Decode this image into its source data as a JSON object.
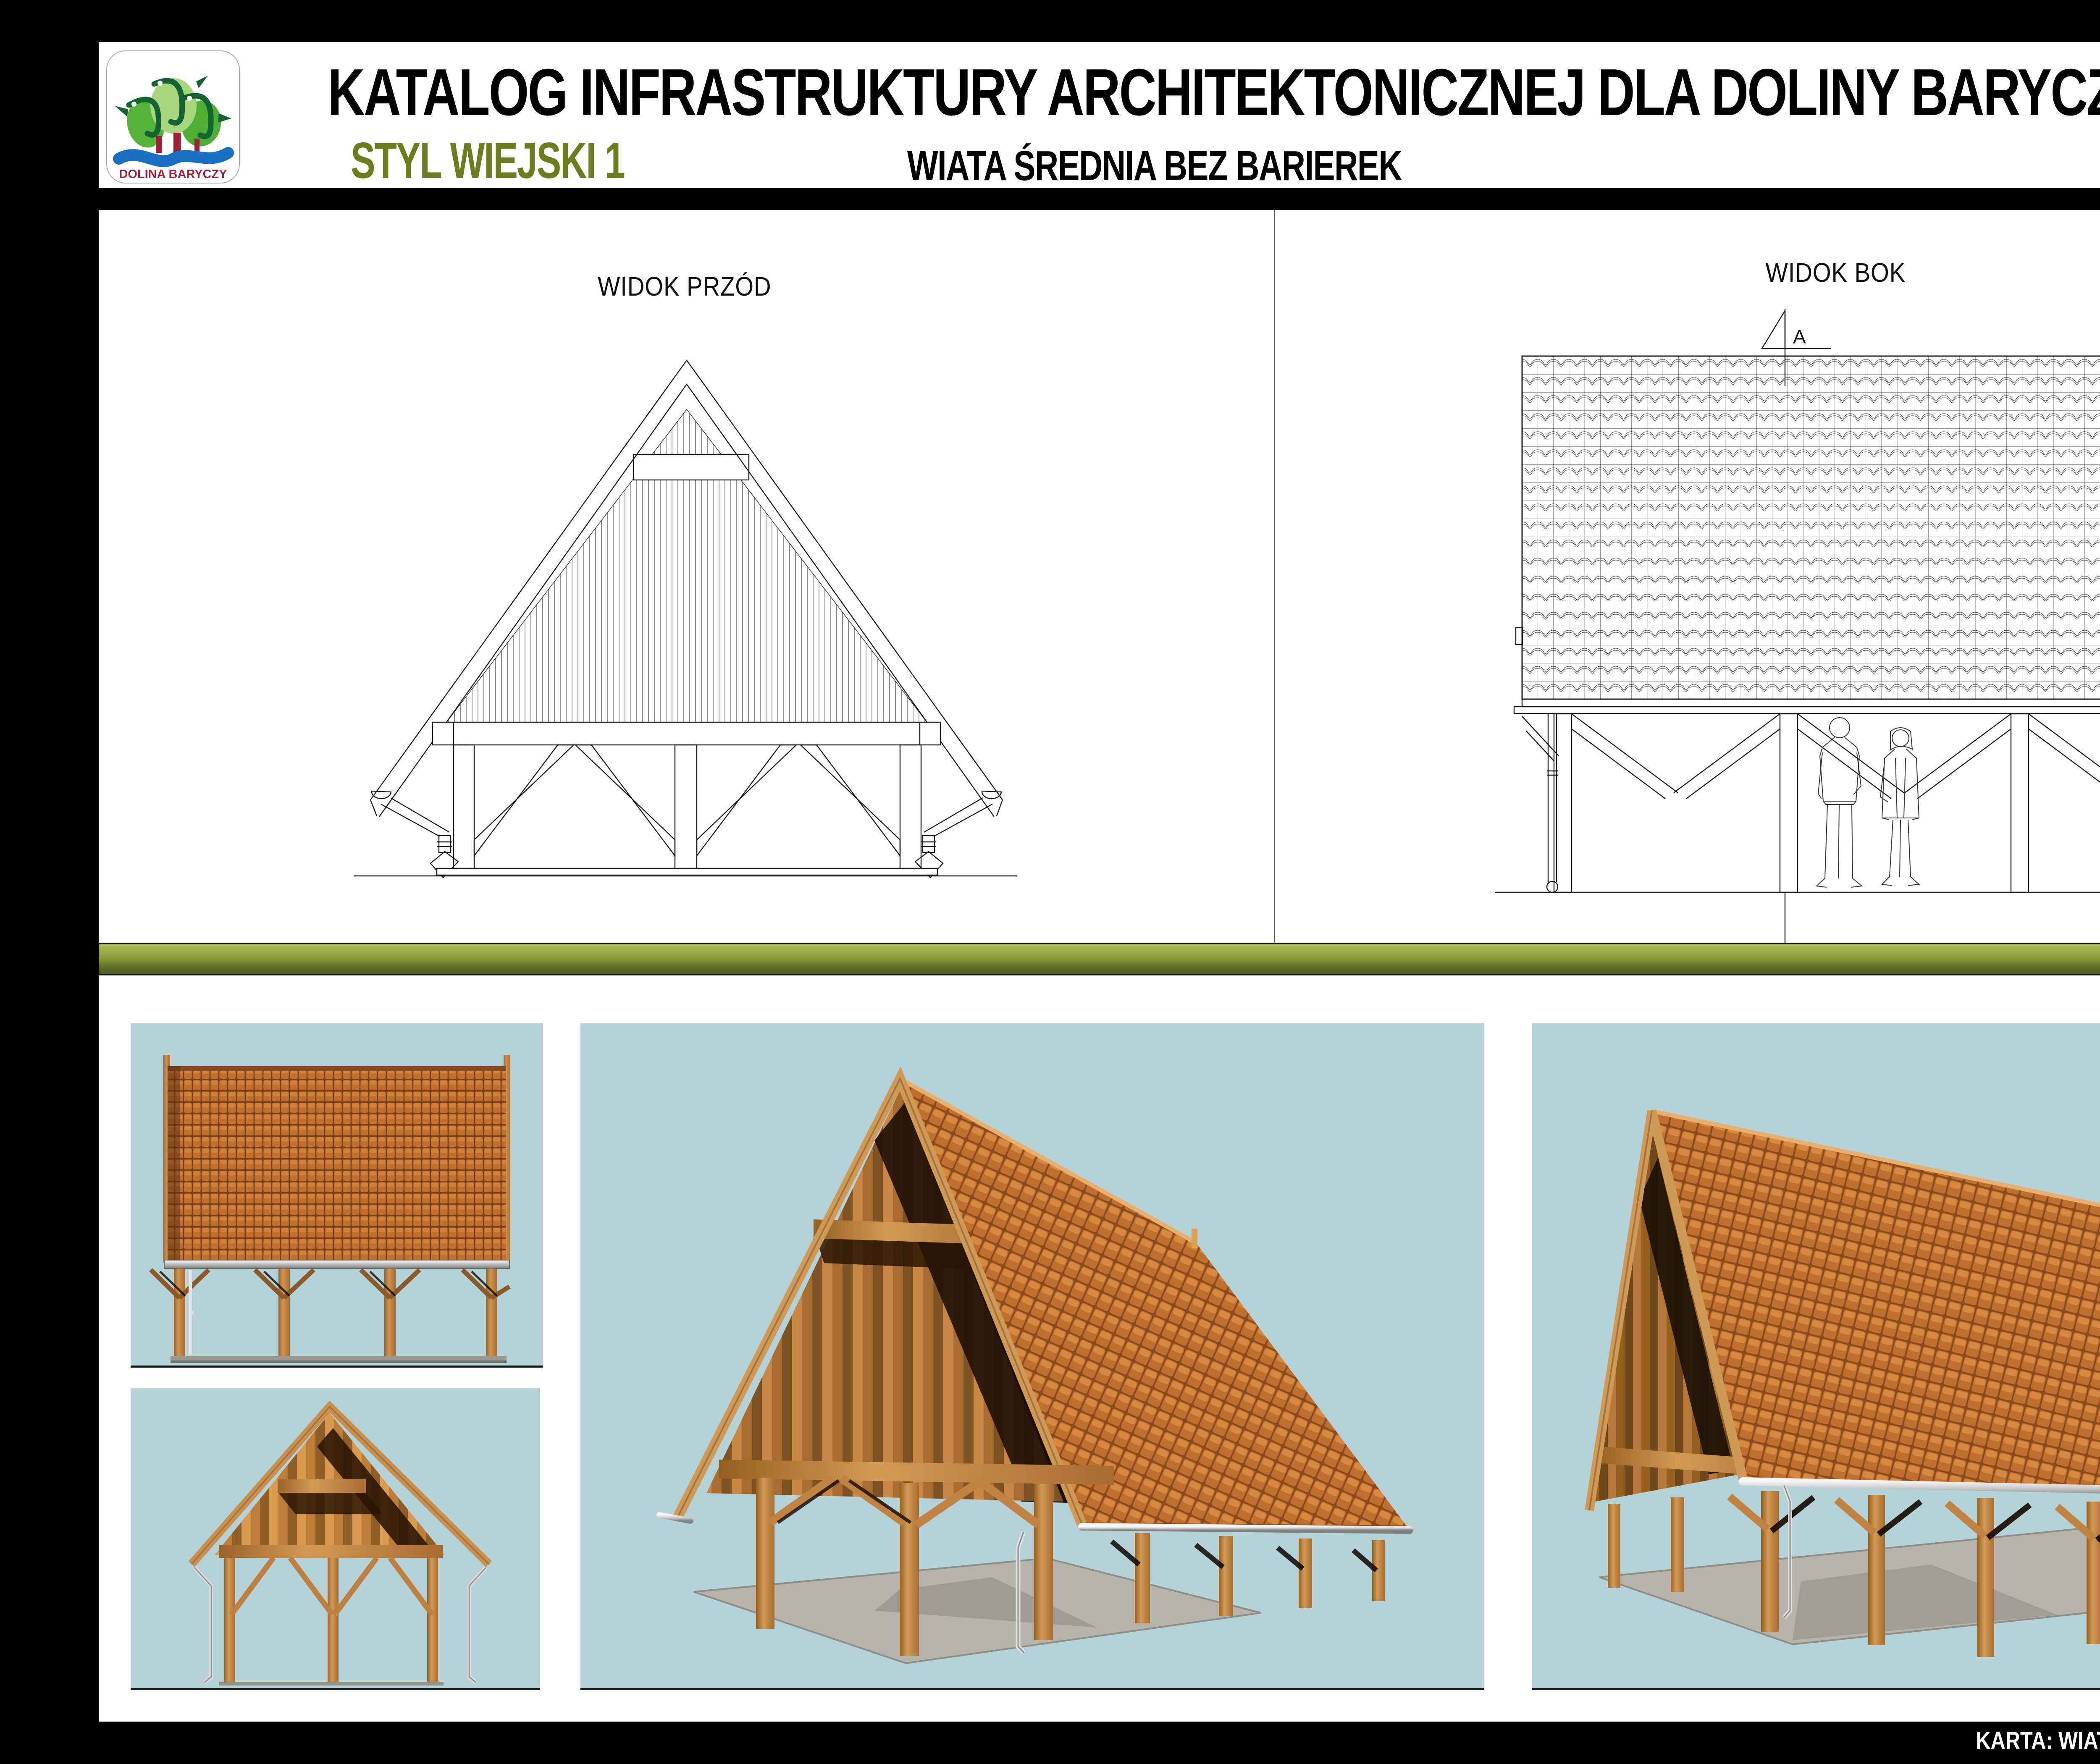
{
  "header": {
    "title": "KATALOG INFRASTRUKTURY ARCHITEKTONICZNEJ DLA DOLINY BARYCZY",
    "style_label": "STYL WIEJSKI 1",
    "item_label": "WIATA ŚREDNIA BEZ BARIEREK",
    "logo_caption": "DOLINA BARYCZY",
    "brand_green": "Green",
    "brand_expert": "EXPERT"
  },
  "drawings": {
    "front_view_label": "WIDOK PRZÓD",
    "side_view_label": "WIDOK BOK",
    "section_marker": "A"
  },
  "footer": {
    "label": "KARTA: WIATA ŚREDNIA BEZ BARIEREK",
    "page": "2/2"
  },
  "colors": {
    "page_background": "#000000",
    "sheet": "#ffffff",
    "divider_bar_top": "#aabd50",
    "divider_bar_bottom": "#4b591d",
    "style_label_green": "#6b7d1f",
    "brand_green": "#8fbe3b",
    "logo_red": "#a02038",
    "logo_blue": "#1a6fc4",
    "logo_dark_green": "#156232",
    "render_panel_blue": "#b5d2d8",
    "roof_tile_orange": "#c06f2f",
    "timber_brown": "#c8904f"
  }
}
